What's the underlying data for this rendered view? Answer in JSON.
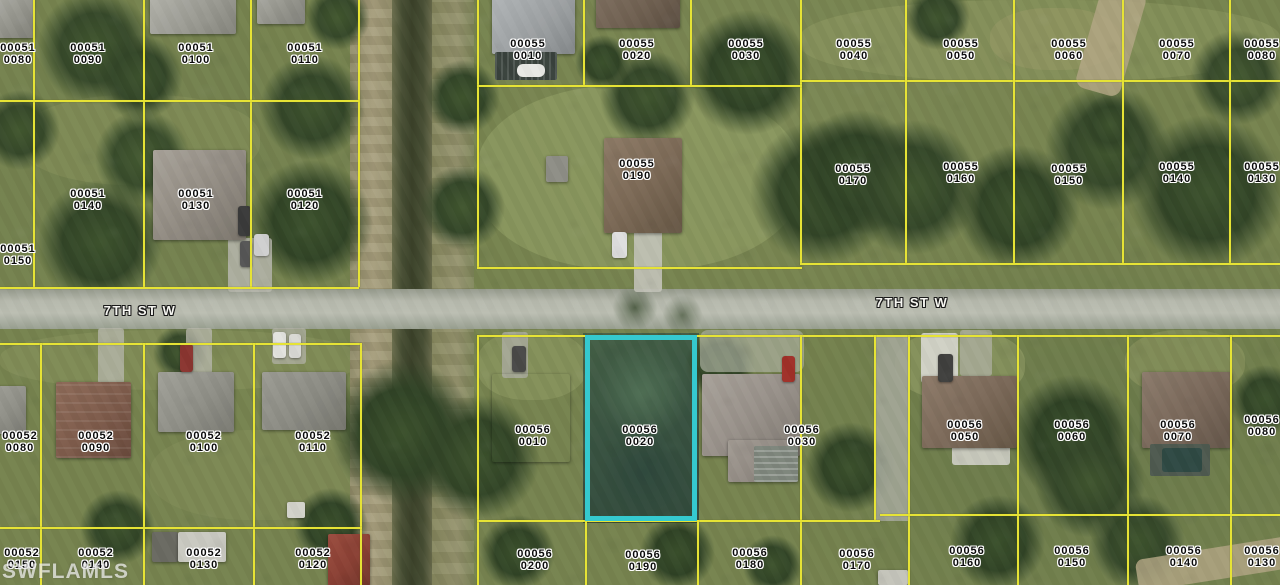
{
  "watermark": {
    "text": "SWFLAMLS"
  },
  "streets": [
    {
      "name": "7TH ST W",
      "x": 140,
      "y": 303
    },
    {
      "name": "7TH ST W",
      "x": 912,
      "y": 295
    }
  ],
  "highlight": {
    "parcel_id": "00056 0020",
    "color": "#35c9cf",
    "x": 585,
    "y": 335,
    "w": 112,
    "h": 186
  },
  "colors": {
    "parcel_line": "#e6e335",
    "label_text": "#0b0b0b",
    "label_halo": "#ffffff",
    "street_text": "#f6f6f1"
  },
  "parcels": [
    {
      "line1": "00051",
      "line2": "0080",
      "x": 18,
      "y": 42
    },
    {
      "line1": "00051",
      "line2": "0090",
      "x": 88,
      "y": 42
    },
    {
      "line1": "00051",
      "line2": "0100",
      "x": 196,
      "y": 42
    },
    {
      "line1": "00051",
      "line2": "0110",
      "x": 305,
      "y": 42
    },
    {
      "line1": "00055",
      "line2": "0010",
      "x": 528,
      "y": 38
    },
    {
      "line1": "00055",
      "line2": "0020",
      "x": 637,
      "y": 38
    },
    {
      "line1": "00055",
      "line2": "0030",
      "x": 746,
      "y": 38
    },
    {
      "line1": "00055",
      "line2": "0040",
      "x": 854,
      "y": 38
    },
    {
      "line1": "00055",
      "line2": "0050",
      "x": 961,
      "y": 38
    },
    {
      "line1": "00055",
      "line2": "0060",
      "x": 1069,
      "y": 38
    },
    {
      "line1": "00055",
      "line2": "0070",
      "x": 1177,
      "y": 38
    },
    {
      "line1": "00055",
      "line2": "0080",
      "x": 1262,
      "y": 38
    },
    {
      "line1": "00051",
      "line2": "0140",
      "x": 88,
      "y": 188
    },
    {
      "line1": "00051",
      "line2": "0130",
      "x": 196,
      "y": 188
    },
    {
      "line1": "00051",
      "line2": "0120",
      "x": 305,
      "y": 188
    },
    {
      "line1": "00051",
      "line2": "0150",
      "x": 18,
      "y": 243
    },
    {
      "line1": "00055",
      "line2": "0190",
      "x": 637,
      "y": 158
    },
    {
      "line1": "00055",
      "line2": "0170",
      "x": 853,
      "y": 163
    },
    {
      "line1": "00055",
      "line2": "0160",
      "x": 961,
      "y": 161
    },
    {
      "line1": "00055",
      "line2": "0150",
      "x": 1069,
      "y": 163
    },
    {
      "line1": "00055",
      "line2": "0140",
      "x": 1177,
      "y": 161
    },
    {
      "line1": "00055",
      "line2": "0130",
      "x": 1262,
      "y": 161
    },
    {
      "line1": "00052",
      "line2": "0080",
      "x": 20,
      "y": 430
    },
    {
      "line1": "00052",
      "line2": "0090",
      "x": 96,
      "y": 430
    },
    {
      "line1": "00052",
      "line2": "0100",
      "x": 204,
      "y": 430
    },
    {
      "line1": "00052",
      "line2": "0110",
      "x": 313,
      "y": 430
    },
    {
      "line1": "00056",
      "line2": "0010",
      "x": 533,
      "y": 424
    },
    {
      "line1": "00056",
      "line2": "0020",
      "x": 640,
      "y": 424
    },
    {
      "line1": "00056",
      "line2": "0030",
      "x": 802,
      "y": 424
    },
    {
      "line1": "00056",
      "line2": "0050",
      "x": 965,
      "y": 419
    },
    {
      "line1": "00056",
      "line2": "0060",
      "x": 1072,
      "y": 419
    },
    {
      "line1": "00056",
      "line2": "0070",
      "x": 1178,
      "y": 419
    },
    {
      "line1": "00056",
      "line2": "0080",
      "x": 1262,
      "y": 414
    },
    {
      "line1": "00052",
      "line2": "0150",
      "x": 22,
      "y": 547
    },
    {
      "line1": "00052",
      "line2": "0140",
      "x": 96,
      "y": 547
    },
    {
      "line1": "00052",
      "line2": "0130",
      "x": 204,
      "y": 547
    },
    {
      "line1": "00052",
      "line2": "0120",
      "x": 313,
      "y": 547
    },
    {
      "line1": "00056",
      "line2": "0200",
      "x": 535,
      "y": 548
    },
    {
      "line1": "00056",
      "line2": "0190",
      "x": 643,
      "y": 549
    },
    {
      "line1": "00056",
      "line2": "0180",
      "x": 750,
      "y": 547
    },
    {
      "line1": "00056",
      "line2": "0170",
      "x": 857,
      "y": 548
    },
    {
      "line1": "00056",
      "line2": "0160",
      "x": 967,
      "y": 545
    },
    {
      "line1": "00056",
      "line2": "0150",
      "x": 1072,
      "y": 545
    },
    {
      "line1": "00056",
      "line2": "0140",
      "x": 1184,
      "y": 545
    },
    {
      "line1": "00056",
      "line2": "0130",
      "x": 1262,
      "y": 545
    }
  ]
}
